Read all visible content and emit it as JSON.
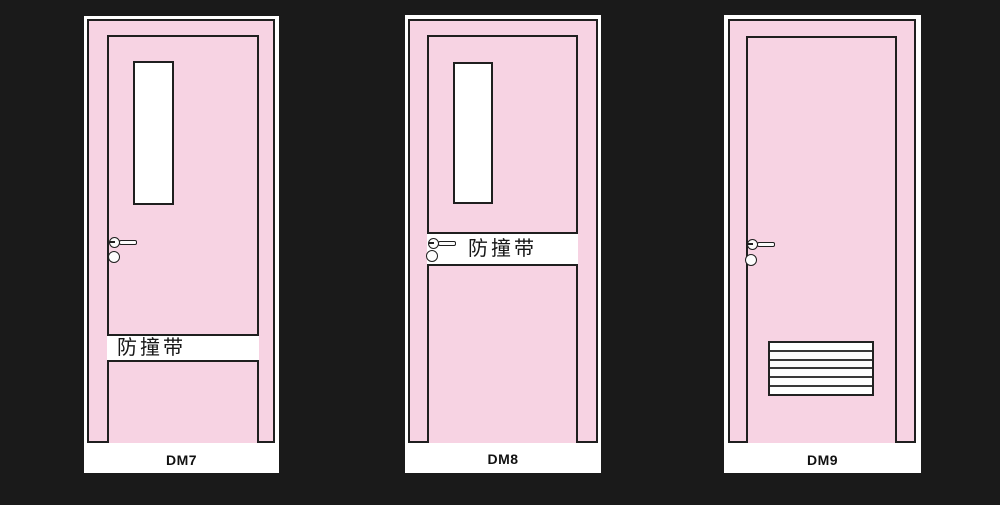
{
  "sheet": {
    "background_color": "#1a1a1a",
    "panel_color": "#ffffff"
  },
  "colors": {
    "door_fill_pink": "#f7d3e3",
    "outline_dark": "#1f1f1f",
    "glass_white": "#ffffff"
  },
  "doors": [
    {
      "label": "DM7",
      "features": {
        "vision_window": true,
        "anti_collision_band": true,
        "band_text": "防撞带",
        "band_location": "lower-third",
        "louver_vent": false,
        "handle": "lever-with-lock-cylinder"
      }
    },
    {
      "label": "DM8",
      "features": {
        "vision_window": true,
        "anti_collision_band": true,
        "band_text": "防撞带",
        "band_location": "middle-at-handle",
        "louver_vent": false,
        "handle": "lever-with-lock-cylinder"
      }
    },
    {
      "label": "DM9",
      "features": {
        "vision_window": false,
        "anti_collision_band": false,
        "band_text": "",
        "louver_vent": true,
        "louver_slats": 6,
        "handle": "lever-with-lock-cylinder"
      }
    }
  ]
}
